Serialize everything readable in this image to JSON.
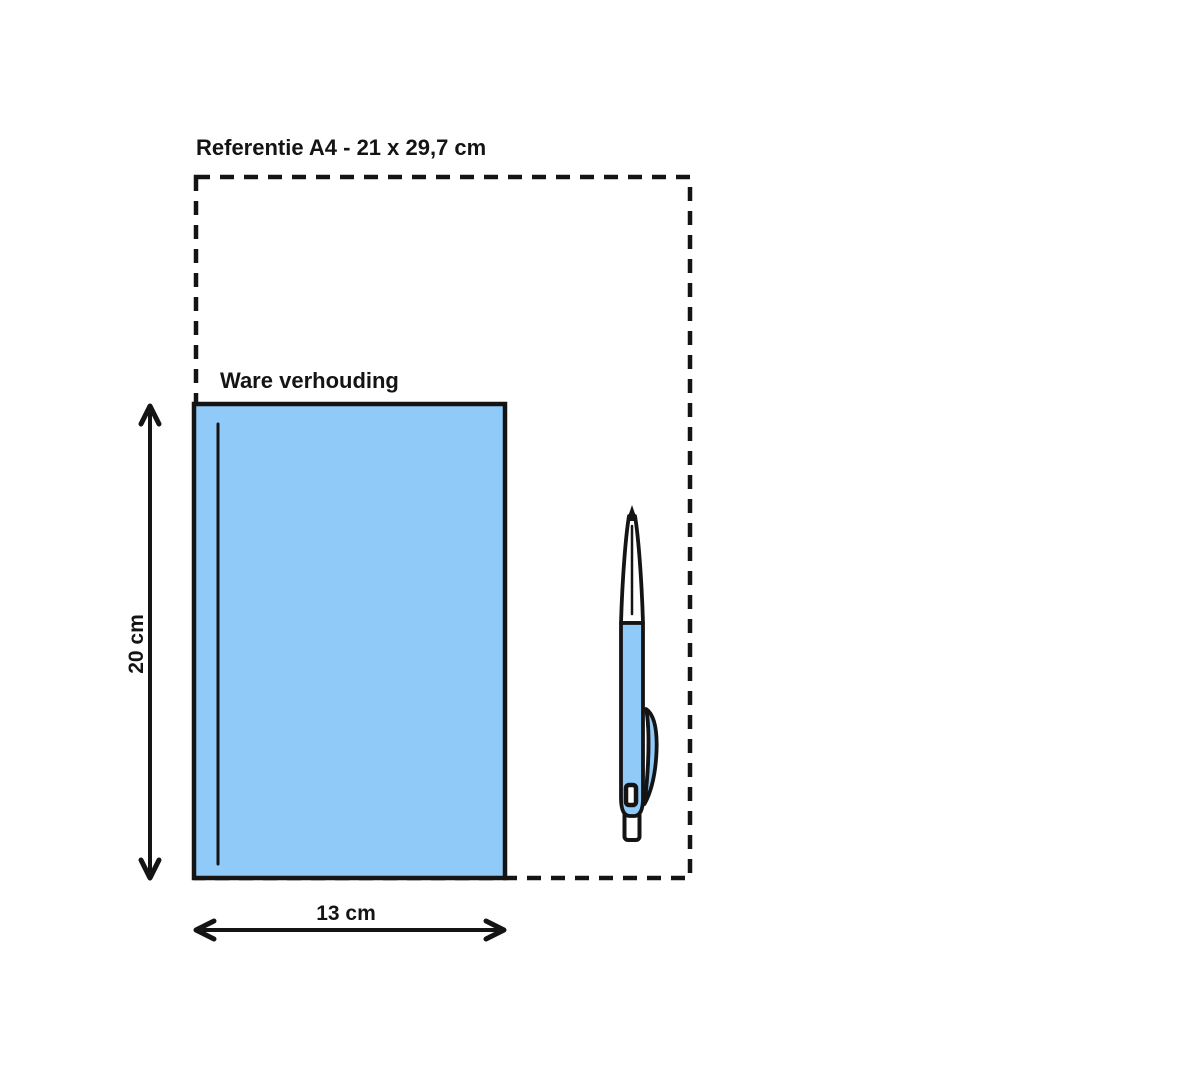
{
  "diagram": {
    "reference_label": "Referentie A4 - 21 x 29,7 cm",
    "true_scale_label": "Ware verhouding",
    "height_label": "20 cm",
    "width_label": "13 cm",
    "reference_size_cm": "21 x 29,7",
    "product_height_cm": "20",
    "product_width_cm": "13"
  },
  "colors": {
    "background": "#ffffff",
    "line": "#141414",
    "product_fill": "#8FCAF9"
  },
  "icons": {
    "pen": "ballpoint-pen-icon"
  }
}
